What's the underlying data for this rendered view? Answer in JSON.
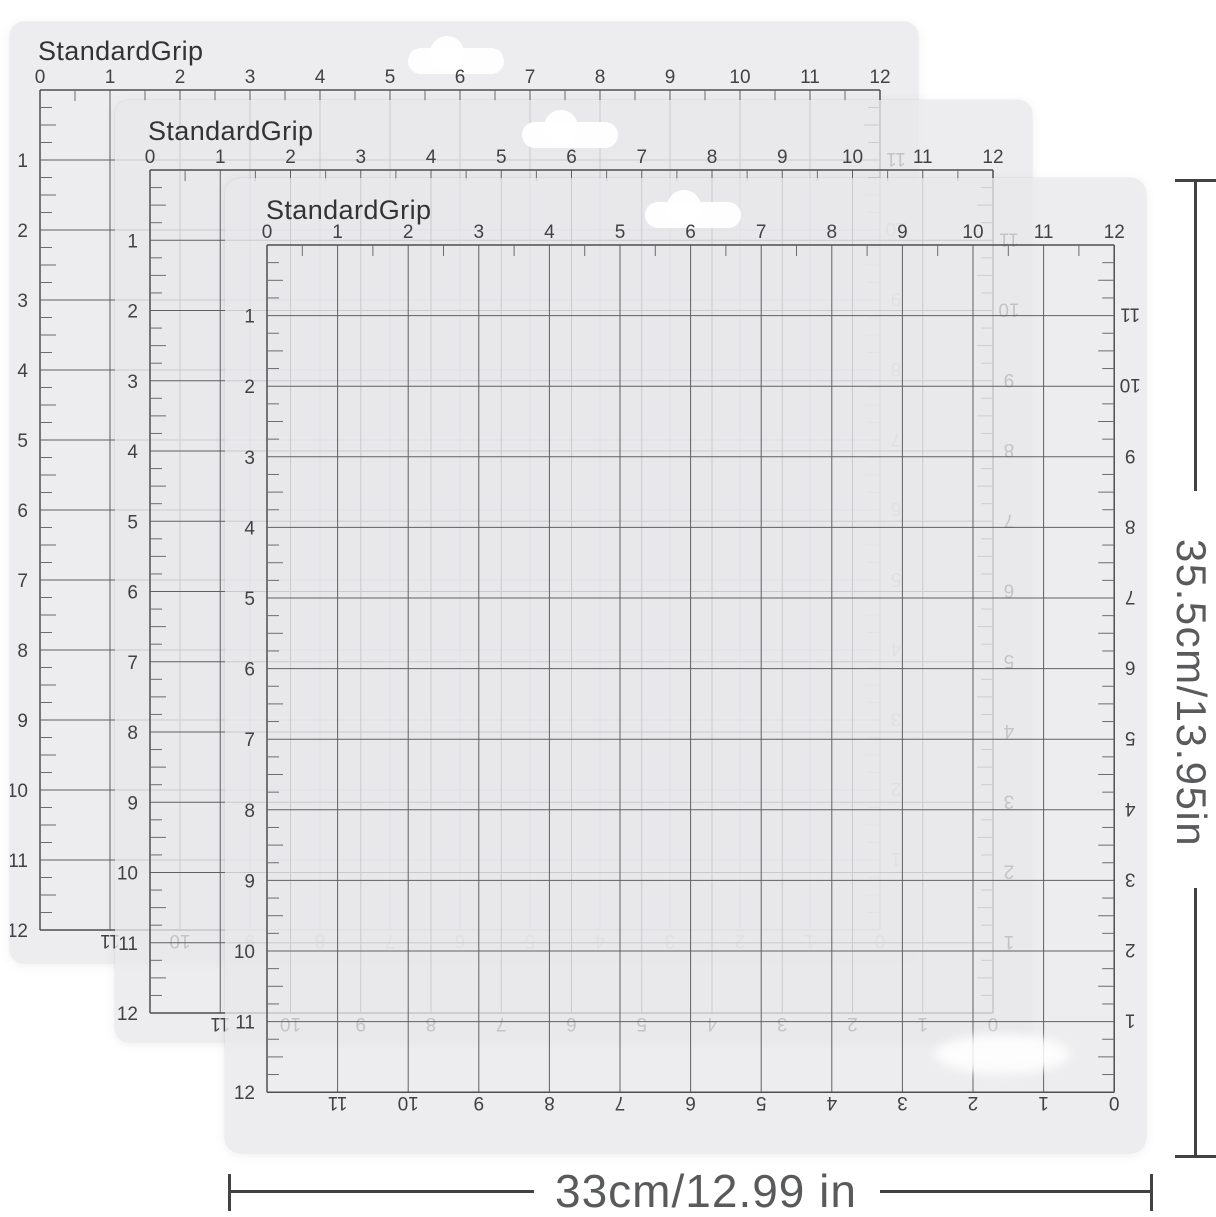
{
  "product": {
    "brand_label": "StandardGrip"
  },
  "rulers": {
    "top_numbers": [
      "0",
      "1",
      "2",
      "3",
      "4",
      "5",
      "6",
      "7",
      "8",
      "9",
      "10",
      "11",
      "12"
    ],
    "left_numbers": [
      "1",
      "2",
      "3",
      "4",
      "5",
      "6",
      "7",
      "8",
      "9",
      "10",
      "11",
      "12"
    ],
    "right_numbers_reversed": [
      "11",
      "10",
      "9",
      "8",
      "7",
      "6",
      "5",
      "4",
      "3",
      "2",
      "1"
    ],
    "bottom_numbers_reversed": [
      "11",
      "10",
      "9",
      "8",
      "7",
      "6",
      "5",
      "4",
      "3",
      "2",
      "1",
      "0"
    ]
  },
  "dimensions": {
    "height_label": "35.5cm/13.95in",
    "width_label": "33cm/12.99 in"
  },
  "colors": {
    "page_bg": "#ffffff",
    "mat_bg": "rgba(232,232,234,0.78)",
    "grid_line": "#606062",
    "grid_edge": "#4e4e50",
    "tick": "#6c6c6e",
    "number": "#424244",
    "brand": "#333335",
    "dim_line": "#424244",
    "dim_text": "#595a5c"
  }
}
